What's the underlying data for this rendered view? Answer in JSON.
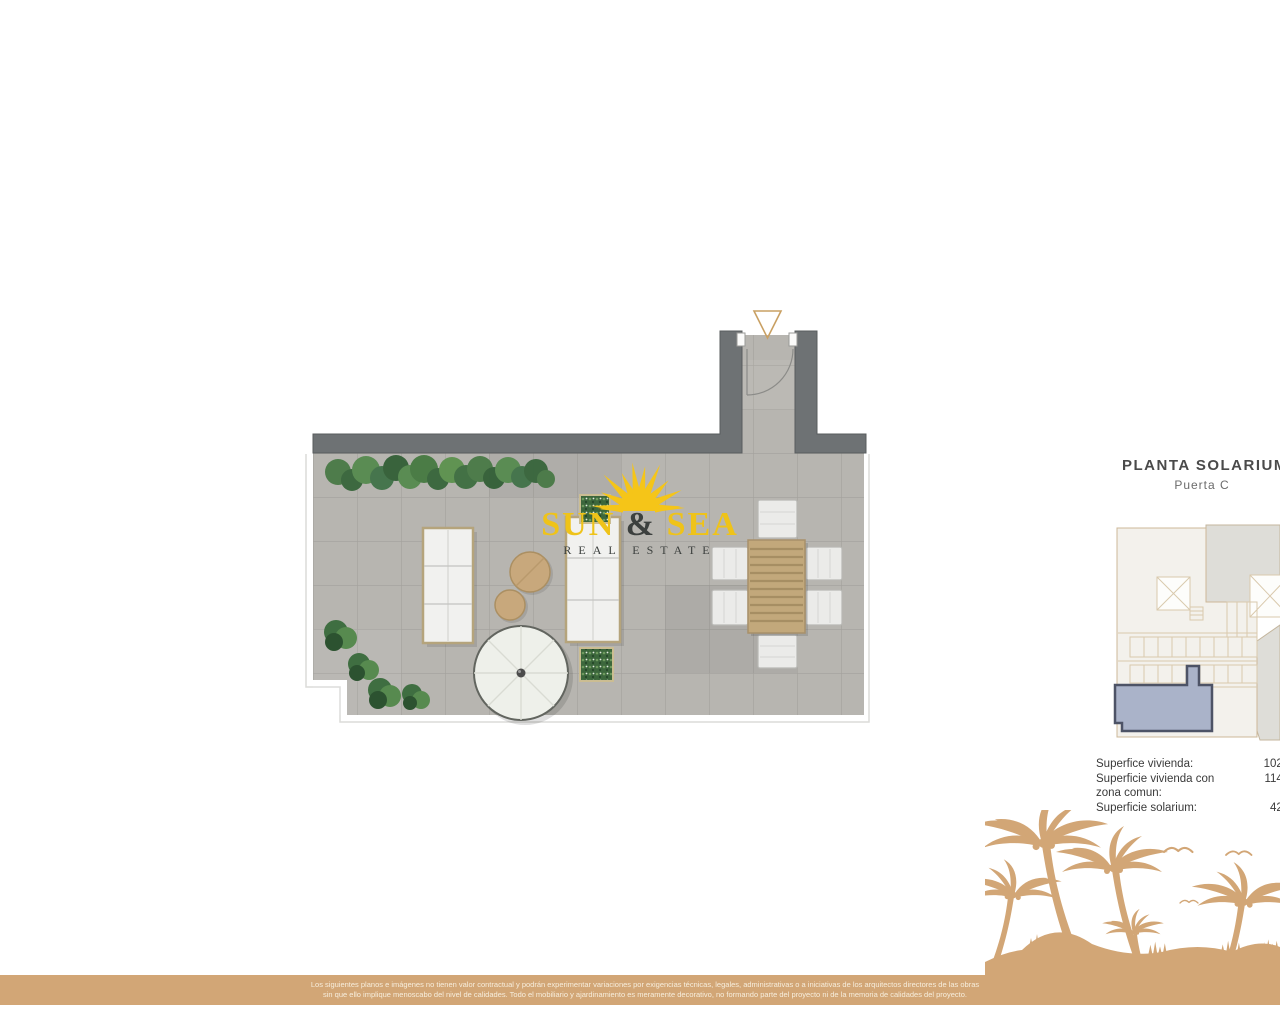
{
  "logo": {
    "word1": "SUN",
    "amp": "&",
    "word2": "SEA",
    "tagline": "REAL ESTATE",
    "yellow": "#efc319",
    "dark": "#3c403e"
  },
  "panel": {
    "title": "PLANTA SOLARIUM",
    "subtitle": "Puerta C",
    "surfaces": [
      {
        "label": "Superfice vivienda:",
        "value": "102."
      },
      {
        "label": "Superficie vivienda con zona comun:",
        "value": "114."
      },
      {
        "label": "Superficie solarium:",
        "value": "42."
      }
    ]
  },
  "plan": {
    "type": "solarium roof terrace floor plan",
    "entrance_marker": "triangle-down",
    "colors": {
      "wall": "#6e7274",
      "tile": "#b7b5b0",
      "accent_tan": "#d2a676",
      "unit_highlight": "#aab3c9",
      "unit_highlight_border": "#4d5366",
      "hedge_green": "#4a7a47",
      "logo_yellow": "#f5c518"
    }
  },
  "minimap": {
    "description": "building key plan with highlighted unit"
  },
  "footer": {
    "line1": "Los siguientes planos e imágenes no tienen valor contractual y podrán experimentar variaciones por exigencias técnicas, legales, administrativas o a iniciativas de los arquitectos directores de las obras",
    "line2": "sin que ello implique menoscabo del nivel de calidades. Todo el mobiliario y ajardinamiento es meramente decorativo, no formando parte del proyecto ni de la memoria de calidades del proyecto."
  }
}
